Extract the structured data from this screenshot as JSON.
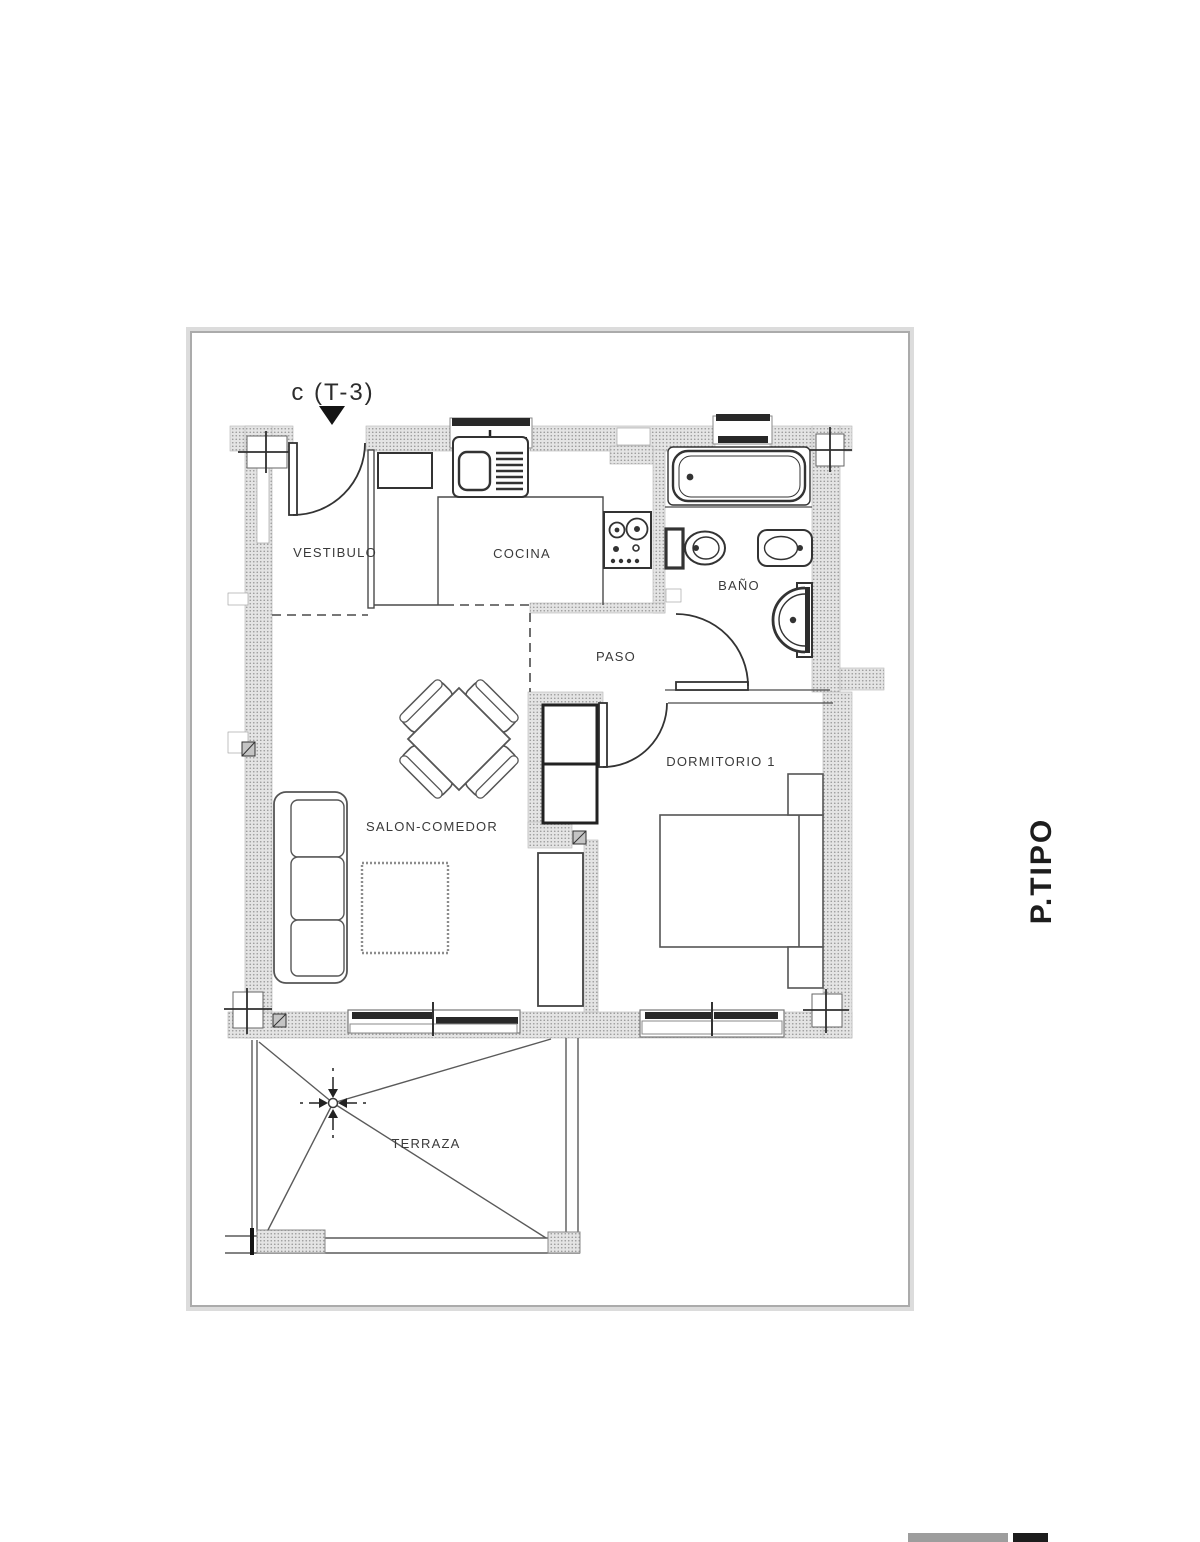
{
  "plan": {
    "unit_label": "c (T-3)",
    "orientation_label": "P.TIPO",
    "rooms": {
      "vestibulo": "VESTIBULO",
      "cocina": "COCINA",
      "bano": "BAÑO",
      "paso": "PASO",
      "dormitorio1": "DORMITORIO 1",
      "salon": "SALON-COMEDOR",
      "terraza": "TERRAZA"
    },
    "colors": {
      "wall_fill": "#e4e4e4",
      "wall_dot": "#969696",
      "line_dark": "#2a2a2a",
      "line_mid": "#555555",
      "frame": "#ababab",
      "scale_bar_gray": "#9d9d9d",
      "scale_bar_black": "#1c1c1c"
    }
  }
}
